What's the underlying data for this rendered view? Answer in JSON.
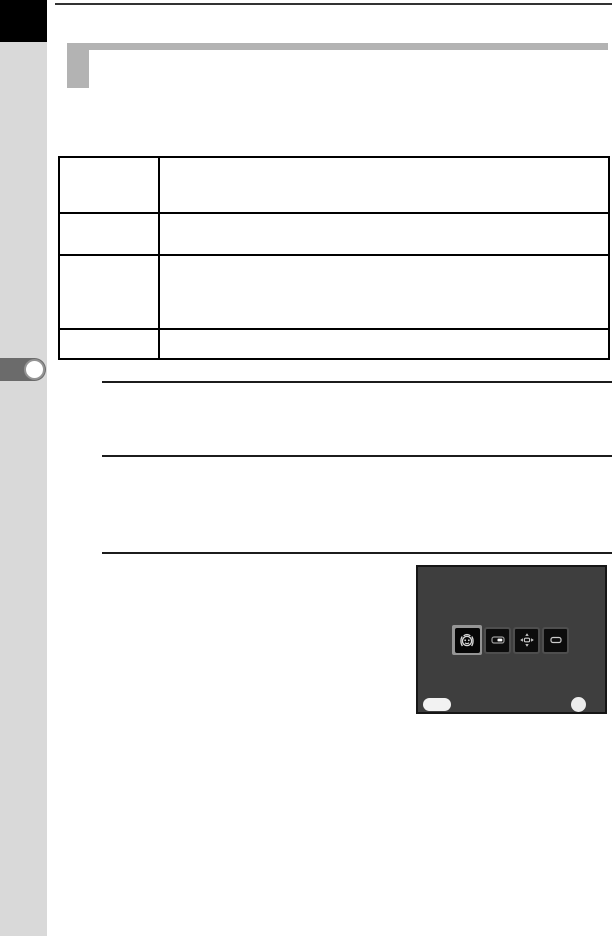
{
  "page": {
    "kind": "camera-manual-page",
    "visible_text": ""
  },
  "colors": {
    "page_bg": "#ffffff",
    "chapter_tab": "#000000",
    "sidebar": "#d9d9d9",
    "sidebar_marker": "#6b6b6b",
    "marker_dot": "#ffffff",
    "marker_dot_ring": "#949494",
    "header_bar": "#b3b3b3",
    "top_rule": "#333333",
    "table_border": "#000000",
    "note_rule": "#1c1c1c",
    "screen_bg": "#3e3e3e",
    "screen_border": "#161616",
    "key_face": "#0c0c0c",
    "key_bezel": "#4e4e4e",
    "selected_frame": "#959595",
    "glyph": "#d8d8d8",
    "screen_pill": "#f2f2f2",
    "screen_dot": "#ececec"
  },
  "table": {
    "columns": 2,
    "rows": [
      {
        "label": "",
        "content": ""
      },
      {
        "label": "",
        "content": ""
      },
      {
        "label": "",
        "content": ""
      },
      {
        "label": "",
        "content": ""
      }
    ]
  },
  "notes": [
    {
      "text": ""
    },
    {
      "text": ""
    }
  ],
  "camera_screen": {
    "keys": [
      {
        "icon": "face-recognition-icon",
        "selected": true
      },
      {
        "icon": "zoom-rocker-icon",
        "selected": false
      },
      {
        "icon": "four-way-controller-icon",
        "selected": false
      },
      {
        "icon": "ok-button-icon",
        "selected": false
      }
    ],
    "bottom_left_pill_label": "",
    "bottom_right_dot_label": ""
  }
}
